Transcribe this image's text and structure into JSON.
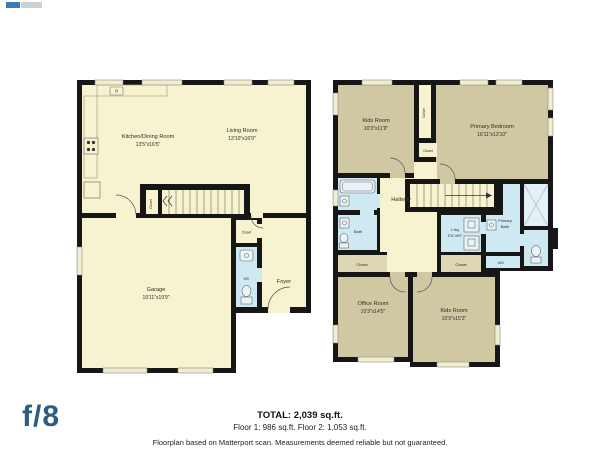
{
  "plans": {
    "floor1": {
      "kitchen": {
        "name": "Kitchen/Dining Room",
        "dims": "13'5\"x16'5\""
      },
      "living": {
        "name": "Living Room",
        "dims": "13'10\"x16'9\""
      },
      "garage": {
        "name": "Garage",
        "dims": "19'11\"x19'9\""
      },
      "foyer": {
        "name": "Foyer"
      },
      "wc": {
        "name": "WC"
      },
      "stair_closet": {
        "name": "Closet"
      },
      "closet": {
        "name": "Closet"
      }
    },
    "floor2": {
      "kids_room_top": {
        "name": "Kids Room",
        "dims": "10'3\"x11'9\""
      },
      "primary_bedroom": {
        "name": "Primary Bedroom",
        "dims": "16'11\"x13'10\""
      },
      "hallway": {
        "name": "Hallway"
      },
      "bath": {
        "name": "Bath"
      },
      "laundry": {
        "name": "L'dry",
        "dims": "5'11\"x5'9\""
      },
      "primary_bath": {
        "line1": "Primary",
        "line2": "Bath"
      },
      "wic": {
        "name": "WIC"
      },
      "closet_strip": {
        "name": "Closet"
      },
      "closet_small": {
        "name": "Closet"
      },
      "closet_bottom_left": {
        "name": "Closet"
      },
      "closet_bottom_center": {
        "name": "Closet"
      },
      "office": {
        "name": "Office Room",
        "dims": "10'3\"x14'5\""
      },
      "kids_room_bottom": {
        "name": "Kids Room",
        "dims": "10'9\"x15'3\""
      }
    }
  },
  "footer": {
    "total": "TOTAL: 2,039 sq.ft.",
    "floors": "Floor 1: 986 sq.ft. Floor 2: 1,053 sq.ft.",
    "disclaimer": "Floorplan based on Matterport scan. Measurements deemed reliable but not guaranteed.",
    "logo": "f/8"
  },
  "colors": {
    "wall": "#161616",
    "room_cream": "#f7f2cf",
    "room_olive": "#cfc8a2",
    "room_khaki": "#ddd7b4",
    "room_blue": "#cfe9f2",
    "logo_blue": "#2b5d7e"
  }
}
